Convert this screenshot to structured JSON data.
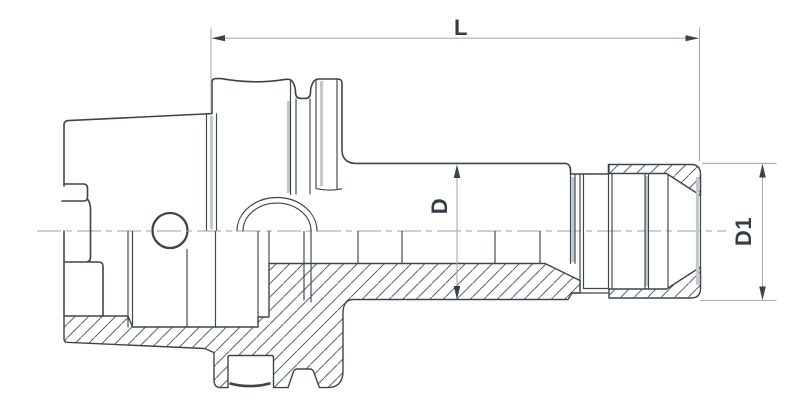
{
  "drawing": {
    "title": "sectioned tool holder technical drawing",
    "view": "side view, lower half in cross-section with hatching"
  },
  "dimensions": {
    "length": {
      "label": "L"
    },
    "body_diameter": {
      "label": "D"
    },
    "nut_diameter": {
      "label": "D1"
    }
  },
  "colors": {
    "outline": "#3b4550",
    "hatch": "#5a6570",
    "dimension": "#a7adb4",
    "shading": "#c2c8ce",
    "label_text": "#333d47",
    "background": "#ffffff"
  }
}
